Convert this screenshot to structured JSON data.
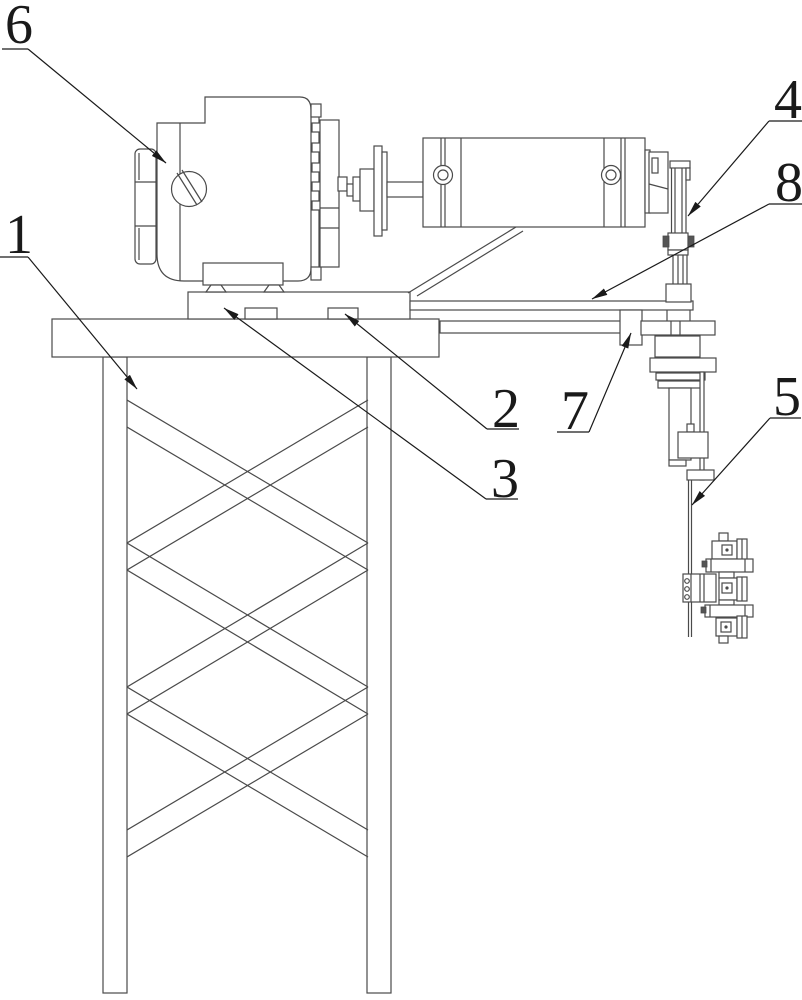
{
  "figure": {
    "background_color": "#ffffff",
    "line_color": "#4a4a4a",
    "callout_color": "#1a1a1a",
    "callouts": [
      {
        "label": "1"
      },
      {
        "label": "2"
      },
      {
        "label": "3"
      },
      {
        "label": "4"
      },
      {
        "label": "5"
      },
      {
        "label": "6"
      },
      {
        "label": "7"
      },
      {
        "label": "8"
      }
    ]
  }
}
